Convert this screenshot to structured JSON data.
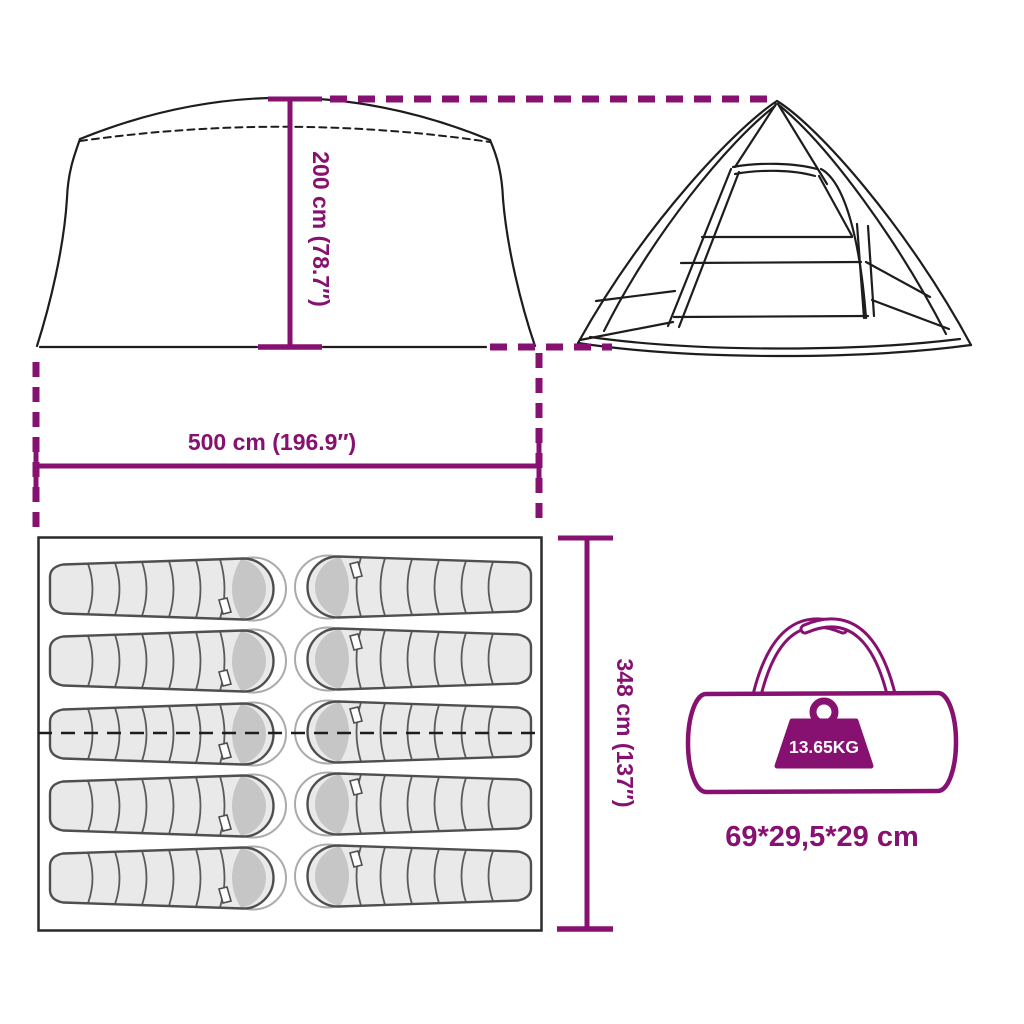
{
  "image": {
    "kind": "product-dimension-diagram",
    "subject": "family tent with sleeping capacity, floor plan and carry bag",
    "background": "#ffffff"
  },
  "colors": {
    "accent_purple": "#861170",
    "drawing_line": "#1d1d1d",
    "bag_outline": "#4f4f4f",
    "bag_fill": "#e9e9e9",
    "bag_hood": "#c6c6c6",
    "bag_liner": "#ababab",
    "weight_label_text": "#ffffff"
  },
  "labels": {
    "tent_height": "200 cm (78.7″)",
    "tent_width": "500 cm (196.9″)",
    "tent_depth": "348 cm (137″)",
    "carry_bag_weight": "13.65KG",
    "carry_bag_size": "69*29,5*29 cm"
  },
  "floor_plan": {
    "sleeping_bag_count": 10,
    "rows": 5,
    "columns": 2
  }
}
